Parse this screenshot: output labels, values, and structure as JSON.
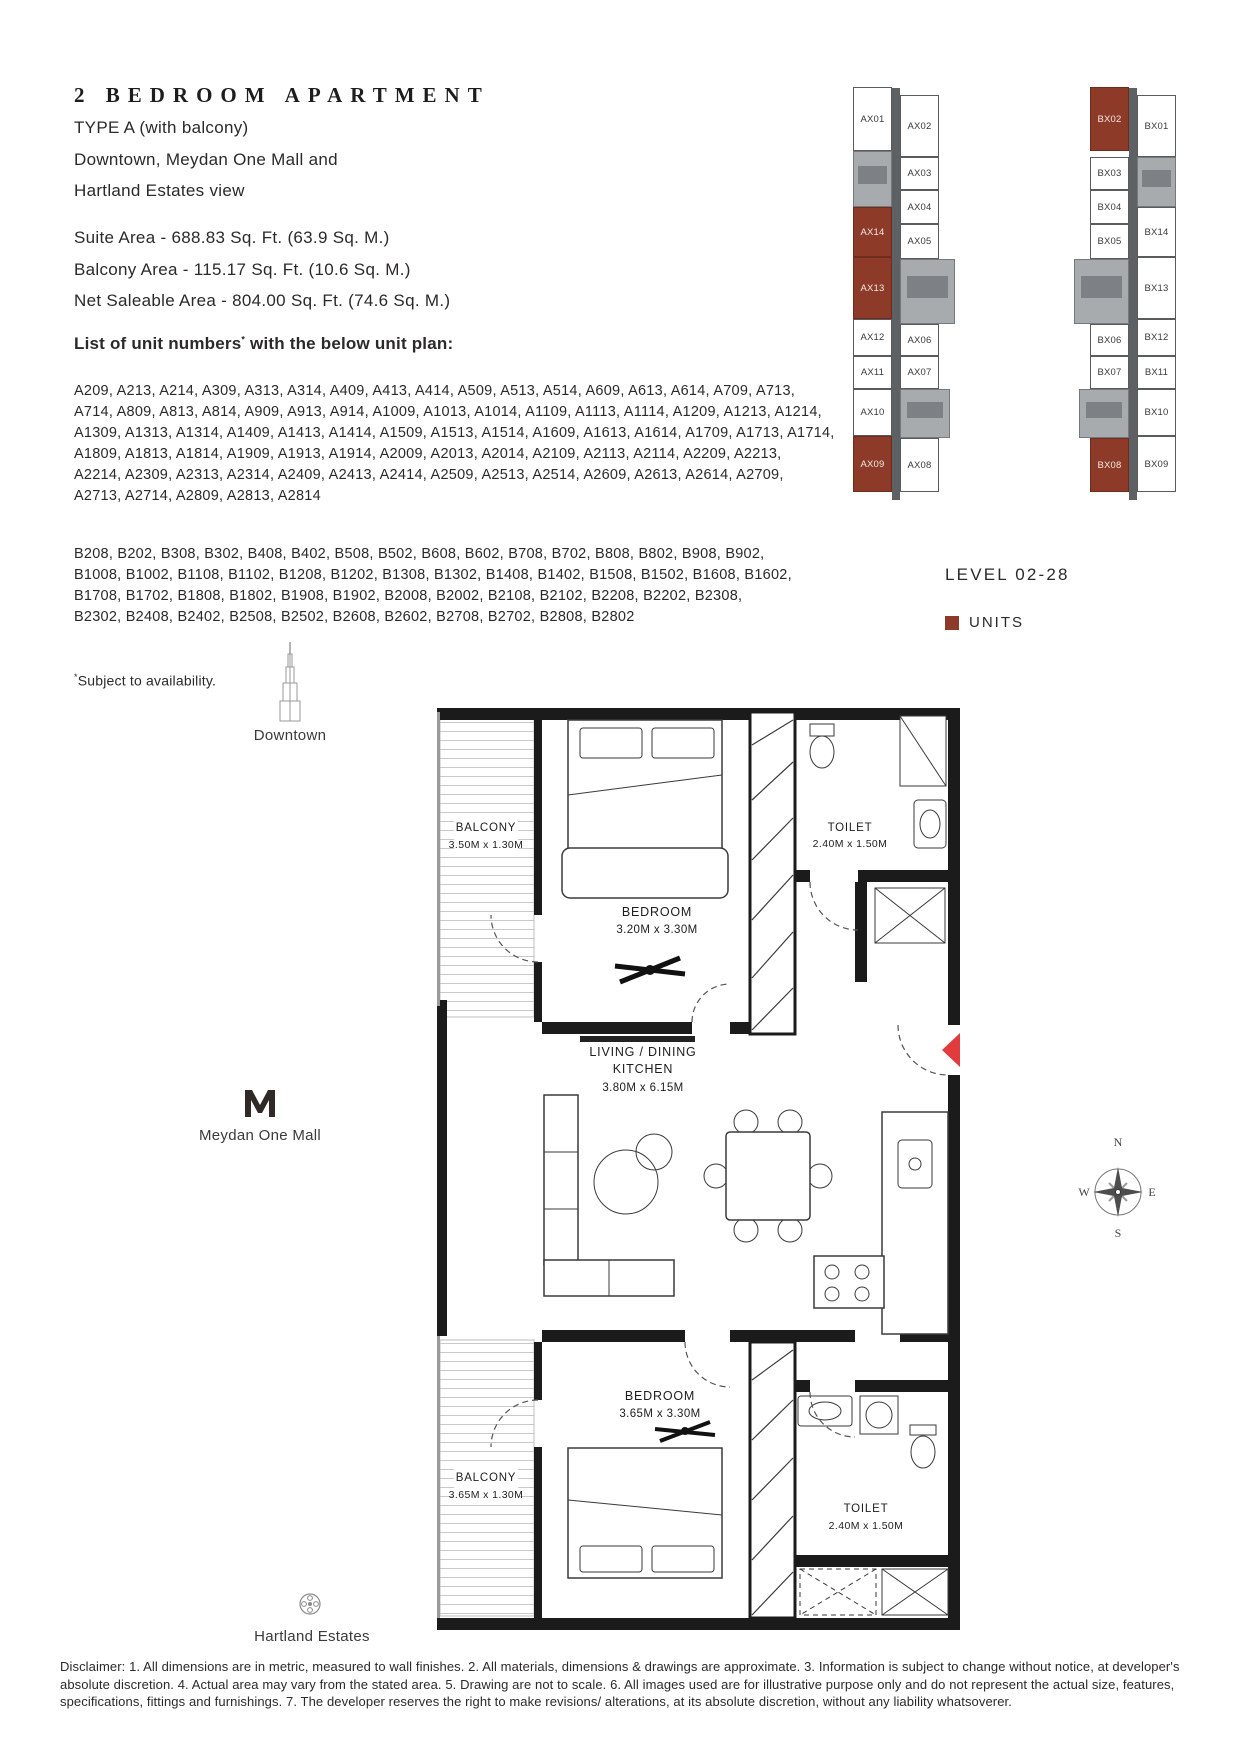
{
  "header": {
    "title": "2 BEDROOM APARTMENT",
    "type_line": "TYPE A (with balcony)",
    "view_line1": "Downtown, Meydan One Mall and",
    "view_line2": "Hartland Estates view",
    "suite_area": "Suite Area - 688.83 Sq. Ft. (63.9 Sq. M.)",
    "balcony_area": "Balcony Area - 115.17 Sq. Ft. (10.6 Sq. M.)",
    "net_area": "Net Saleable Area - 804.00 Sq. Ft. (74.6 Sq. M.)"
  },
  "units": {
    "list_heading": "List of unit numbers",
    "note_symbol": "*",
    "list_heading_suffix": " with the below unit plan:",
    "a_lines": [
      "A209, A213, A214, A309, A313, A314, A409, A413, A414, A509, A513, A514, A609, A613, A614, A709, A713,",
      "A714, A809, A813, A814, A909, A913, A914, A1009, A1013, A1014, A1109, A1113, A1114, A1209, A1213, A1214,",
      "A1309, A1313, A1314, A1409, A1413, A1414, A1509, A1513, A1514, A1609, A1613, A1614, A1709, A1713, A1714,",
      "A1809, A1813, A1814, A1909, A1913, A1914, A2009, A2013, A2014, A2109, A2113, A2114, A2209, A2213,",
      "A2214, A2309, A2313, A2314, A2409, A2413, A2414, A2509, A2513, A2514, A2609, A2613, A2614, A2709,",
      "A2713, A2714, A2809, A2813, A2814"
    ],
    "b_lines": [
      "B208, B202, B308, B302, B408, B402, B508, B502, B608, B602, B708, B702, B808, B802, B908, B902,",
      "B1008, B1002, B1108, B1102, B1208, B1202, B1308, B1302, B1408, B1402, B1508, B1502, B1608, B1602,",
      "B1708, B1702, B1808, B1802, B1908, B1902, B2008, B2002, B2108, B2102, B2208, B2202, B2308,",
      "B2302, B2408, B2402, B2508, B2502, B2608, B2602, B2708, B2702, B2808, B2802"
    ],
    "note": "Subject to availability."
  },
  "keyplan": {
    "level_label": "LEVEL 02-28",
    "legend_label": "UNITS",
    "unit_color": "#8d3a28",
    "tower_a": {
      "cells": [
        "AX01",
        "AX14",
        "AX13",
        "AX12",
        "AX11",
        "AX10",
        "AX09",
        "AX02",
        "AX03",
        "AX04",
        "AX05",
        "AX06",
        "AX07",
        "AX08"
      ]
    },
    "tower_b": {
      "cells": [
        "BX02",
        "BX03",
        "BX04",
        "BX05",
        "BX06",
        "BX07",
        "BX08",
        "BX01",
        "BX14",
        "BX13",
        "BX12",
        "BX11",
        "BX10",
        "BX09"
      ]
    }
  },
  "landmarks": {
    "downtown": "Downtown",
    "meydan": "Meydan One Mall",
    "hartland": "Hartland Estates"
  },
  "floorplan": {
    "balcony_top": {
      "name": "BALCONY",
      "dims": "3.50M x 1.30M"
    },
    "bedroom_top": {
      "name": "BEDROOM",
      "dims": "3.20M x 3.30M"
    },
    "toilet_top": {
      "name": "TOILET",
      "dims": "2.40M x 1.50M"
    },
    "living": {
      "name_line1": "LIVING / DINING",
      "name_line2": "KITCHEN",
      "dims": "3.80M x 6.15M"
    },
    "bedroom_bottom": {
      "name": "BEDROOM",
      "dims": "3.65M x 3.30M"
    },
    "balcony_bottom": {
      "name": "BALCONY",
      "dims": "3.65M x 1.30M"
    },
    "toilet_bottom": {
      "name": "TOILET",
      "dims": "2.40M x 1.50M"
    }
  },
  "compass": {
    "n": "N",
    "e": "E",
    "s": "S",
    "w": "W"
  },
  "disclaimer": "Disclaimer: 1. All dimensions are in metric, measured to wall finishes. 2. All materials, dimensions & drawings are approximate. 3. Information is subject to change without notice, at developer's absolute discretion. 4. Actual area may vary from the stated area. 5. Drawing are not to scale. 6. All images used are for illustrative purpose only and do not represent the actual size, features, specifications, fittings and furnishings. 7. The developer reserves the right to make revisions/ alterations, at its absolute discretion, without any liability whatsoverer."
}
